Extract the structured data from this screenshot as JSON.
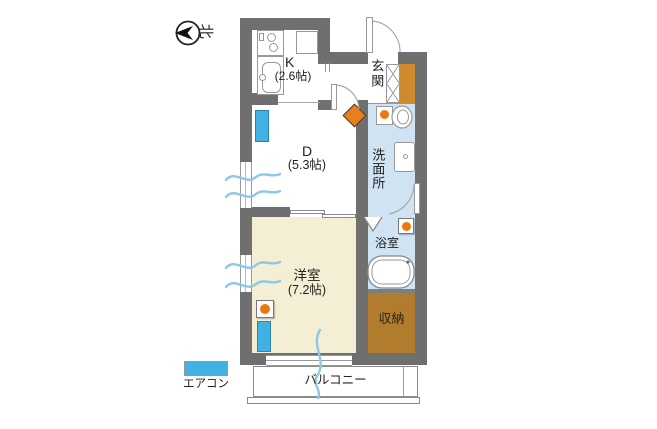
{
  "compass": {
    "north_label": "北"
  },
  "rooms": {
    "kitchen": {
      "label": "K",
      "size": "(2.6帖)"
    },
    "dining": {
      "label": "D",
      "size": "(5.3帖)"
    },
    "western_room": {
      "label": "洋室",
      "size": "(7.2帖)"
    },
    "entrance": {
      "label": "玄関"
    },
    "washroom": {
      "label": "洗面所"
    },
    "bathroom": {
      "label": "浴室"
    },
    "storage": {
      "label": "収納"
    },
    "balcony": {
      "label": "バルコニー"
    }
  },
  "legend": {
    "aircon_label": "エアコン",
    "aircon_color": "#41b1e3"
  },
  "colors": {
    "wall": "#6f6f6f",
    "wet_area_floor": "#cfe3f2",
    "western_room_floor": "#f3eed4",
    "storage_floor": "#b27c2e",
    "shoe_cabinet": "#cf8a2e",
    "marker_orange": "#e8780f",
    "wave_blue": "#8cc8ea"
  }
}
